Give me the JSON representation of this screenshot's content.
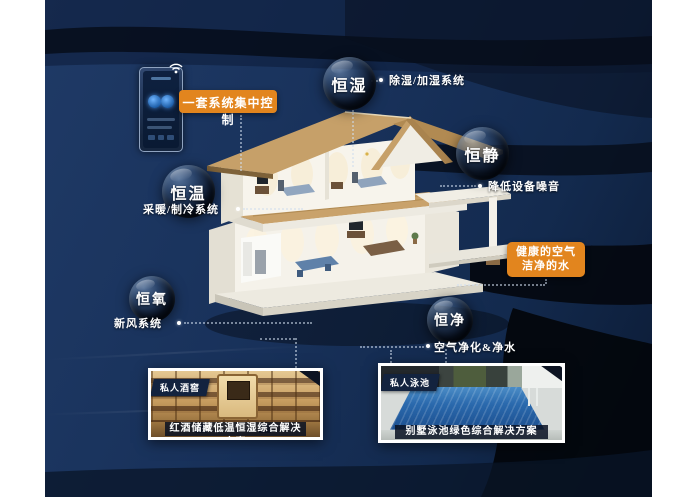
{
  "poster": {
    "control_label": "一套系统集中控制",
    "health_box": {
      "line1": "健康的空气",
      "line2": "洁净的水"
    },
    "bubbles": [
      {
        "id": "heng-shi",
        "label": "恒湿",
        "desc": "除湿/加湿系统"
      },
      {
        "id": "heng-jing",
        "label": "恒静",
        "desc": "降低设备噪音"
      },
      {
        "id": "heng-wen",
        "label": "恒温",
        "desc": "采暖/制冷系统"
      },
      {
        "id": "heng-yang",
        "label": "恒氧",
        "desc": "新风系统"
      },
      {
        "id": "heng-jing2",
        "label": "恒净",
        "desc": "空气净化&净水"
      }
    ],
    "cards": [
      {
        "badge": "私人酒窖",
        "caption": "红酒储藏低温恒湿综合解决方案"
      },
      {
        "badge": "私人泳池",
        "caption": "别墅泳池绿色综合解决方案"
      }
    ],
    "icons": [
      "wifi-icon",
      "smart-panel-icon",
      "house-illustration"
    ],
    "colors": {
      "accent_orange": "#E2851E",
      "bg_navy": "#18315A",
      "swirl_dark": "#04080F",
      "bubble_text": "#FFFFFF"
    }
  }
}
